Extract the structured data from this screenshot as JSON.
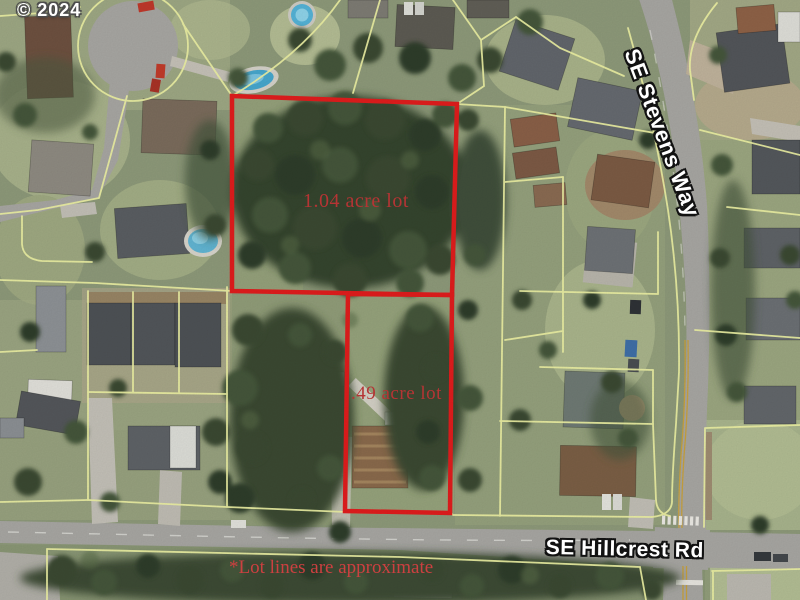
{
  "map": {
    "copyright": "© 2024",
    "lots": [
      {
        "label": "1.04 acre lot"
      },
      {
        "label": ".49 acre lot"
      }
    ],
    "streets": [
      {
        "name": "SE Stevens Way"
      },
      {
        "name": "SE Hillcrest Rd"
      }
    ],
    "disclaimer": "*Lot lines are approximate",
    "colors": {
      "lot_outline": "#e11d1d",
      "lot_label": "#b53434",
      "disclaimer_red": "#cc4040",
      "parcel_line": "#eef2a4",
      "road_gray": "#a8a7a3",
      "street_label_fill": "#ffffff",
      "street_label_outline": "#121212",
      "watermark_fill": "#ffffff",
      "watermark_outline": "#4c4c4c"
    }
  }
}
